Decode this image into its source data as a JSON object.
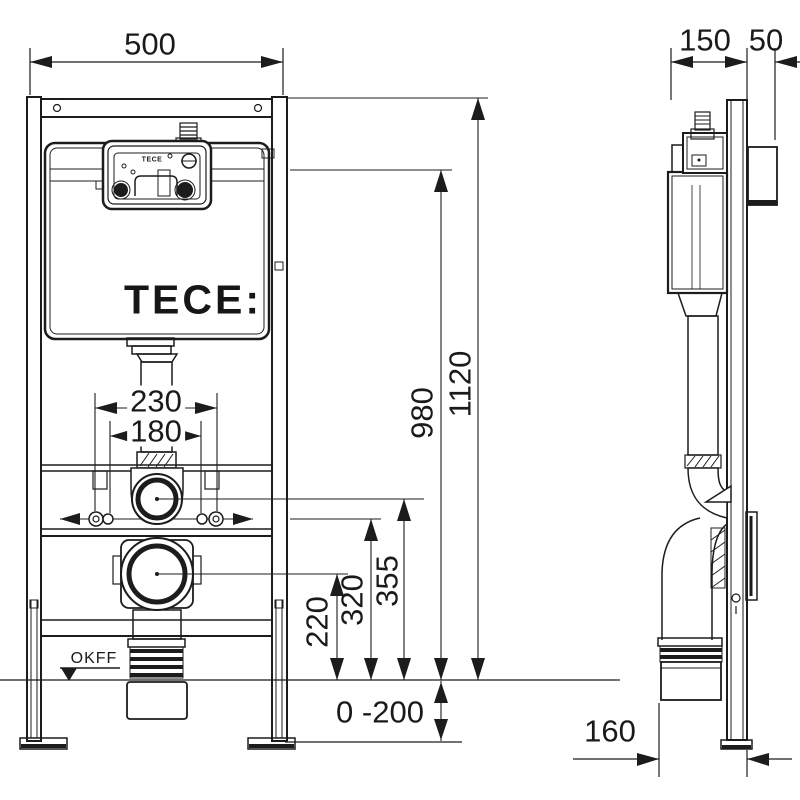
{
  "title": "TECE wall-mounted WC installation frame dimensional drawing",
  "colors": {
    "line": "#1c1c1c",
    "background": "#ffffff"
  },
  "logo": {
    "brand": "TECE:",
    "unit_microtext": "TECE"
  },
  "front_view": {
    "width": "500",
    "total_height": "1120",
    "top_bracket_height": "980",
    "outer_fixing_spread": "230",
    "inner_fixing_spread": "180",
    "drain_axis_height": "220",
    "fixing_rod_height": "320",
    "flush_pipe_height": "355",
    "leg_adjust_range": "0 -200",
    "floor_level_label": "OKFF"
  },
  "side_view": {
    "frame_depth": "150",
    "rail_offset": "50",
    "drain_outlet_offset": "160"
  }
}
